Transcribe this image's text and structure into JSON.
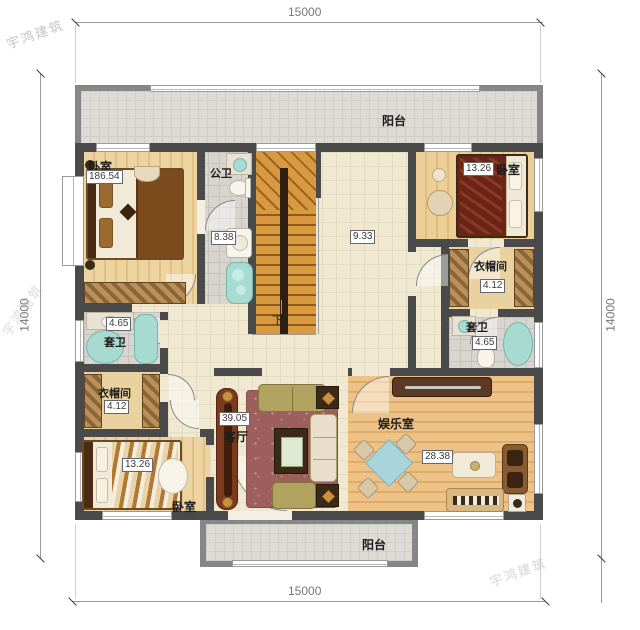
{
  "watermark": {
    "text": "宇鸿建筑"
  },
  "dims": {
    "top": "15000",
    "bottom": "15000",
    "left": "14000",
    "right": "14000"
  },
  "rooms": {
    "balcony_top": {
      "label": "阳台"
    },
    "balcony_bottom": {
      "label": "阳台"
    },
    "bedroom_tl": {
      "label": "卧室",
      "area": "186.54"
    },
    "bath_top": {
      "label": "公卫",
      "area": "8.38"
    },
    "hall": {
      "area": "9.33"
    },
    "stairs": {
      "down": "下"
    },
    "bedroom_tr": {
      "label": "卧室",
      "area": "13.26"
    },
    "closet_r": {
      "label": "衣帽间",
      "area": "4.12"
    },
    "bath_r": {
      "label": "套卫",
      "area": "4.65"
    },
    "bath_l": {
      "label": "套卫",
      "area": "4.65"
    },
    "closet_l": {
      "label": "衣帽间",
      "area": "4.12"
    },
    "bedroom_bl": {
      "label": "卧室",
      "area": "13.26"
    },
    "living": {
      "label": "客厅",
      "area": "39.05"
    },
    "ent": {
      "label": "娱乐室",
      "area": "28.38"
    }
  },
  "colors": {
    "wall": "#4a4a4a",
    "balcony_wall": "#868686",
    "fixture_teal": "#a7dbd1",
    "rug": "#9c5f5c"
  }
}
